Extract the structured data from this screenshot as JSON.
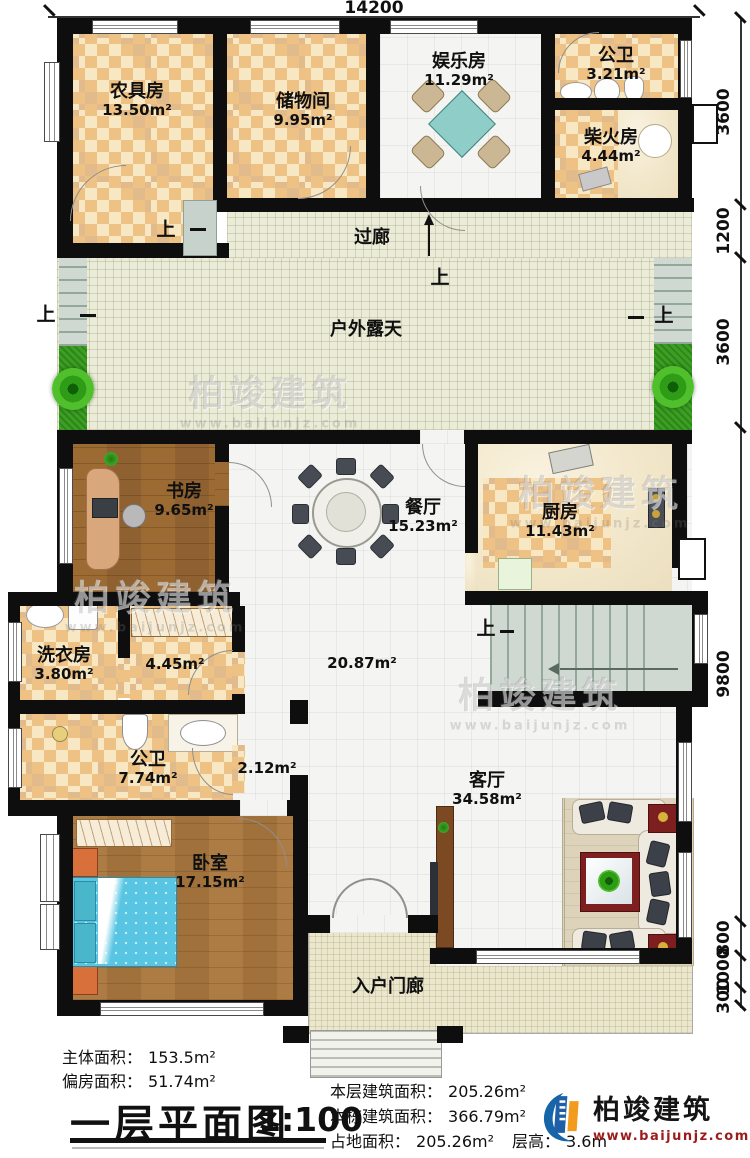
{
  "plan": {
    "top_dimension": "14200",
    "right_dimensions": [
      "3600",
      "1200",
      "3600",
      "9800",
      "800",
      "1000",
      "300"
    ],
    "stair_up_label": "上",
    "rooms": {
      "nongju": {
        "name": "农具房",
        "area": "13.50m²"
      },
      "chuwu": {
        "name": "储物间",
        "area": "9.95m²"
      },
      "yule": {
        "name": "娱乐房",
        "area": "11.29m²"
      },
      "gongwei_top": {
        "name": "公卫",
        "area": "3.21m²"
      },
      "chaihuo": {
        "name": "柴火房",
        "area": "4.44m²"
      },
      "guolang": {
        "name": "过廊"
      },
      "huwai": {
        "name": "户外露天"
      },
      "shufang": {
        "name": "书房",
        "area": "9.65m²"
      },
      "canting": {
        "name": "餐厅",
        "area": "15.23m²"
      },
      "chufang": {
        "name": "厨房",
        "area": "11.43m²"
      },
      "xiyifang": {
        "name": "洗衣房",
        "area": "3.80m²"
      },
      "corridor": {
        "area": "4.45m²"
      },
      "hall": {
        "area": "20.87m²"
      },
      "gongwei_main": {
        "name": "公卫",
        "area": "7.74m²"
      },
      "passage": {
        "area": "2.12m²"
      },
      "woshi": {
        "name": "卧室",
        "area": "17.15m²"
      },
      "keting": {
        "name": "客厅",
        "area": "34.58m²"
      },
      "menlang": {
        "name": "入户门廊"
      }
    }
  },
  "stats": {
    "left": [
      {
        "label": "主体面积：",
        "value": "153.5m²"
      },
      {
        "label": "偏房面积：",
        "value": "51.74m²"
      }
    ],
    "right": [
      {
        "label": "本层建筑面积：",
        "value": "205.26m²"
      },
      {
        "label": "本栋建筑面积：",
        "value": "366.79m²"
      },
      {
        "label": "占地面积：",
        "value": "205.26m²"
      }
    ],
    "floor_height": {
      "label": "层高：",
      "value": "3.6m"
    }
  },
  "title_block": {
    "title": "一层平面图",
    "scale": "1:100"
  },
  "brand": {
    "name": "柏竣建筑",
    "url": "www.baijunjz.com",
    "colors": {
      "logo_blue": "#1565a8",
      "logo_orange": "#f29b1d",
      "url_red": "#9c1c1c"
    }
  }
}
